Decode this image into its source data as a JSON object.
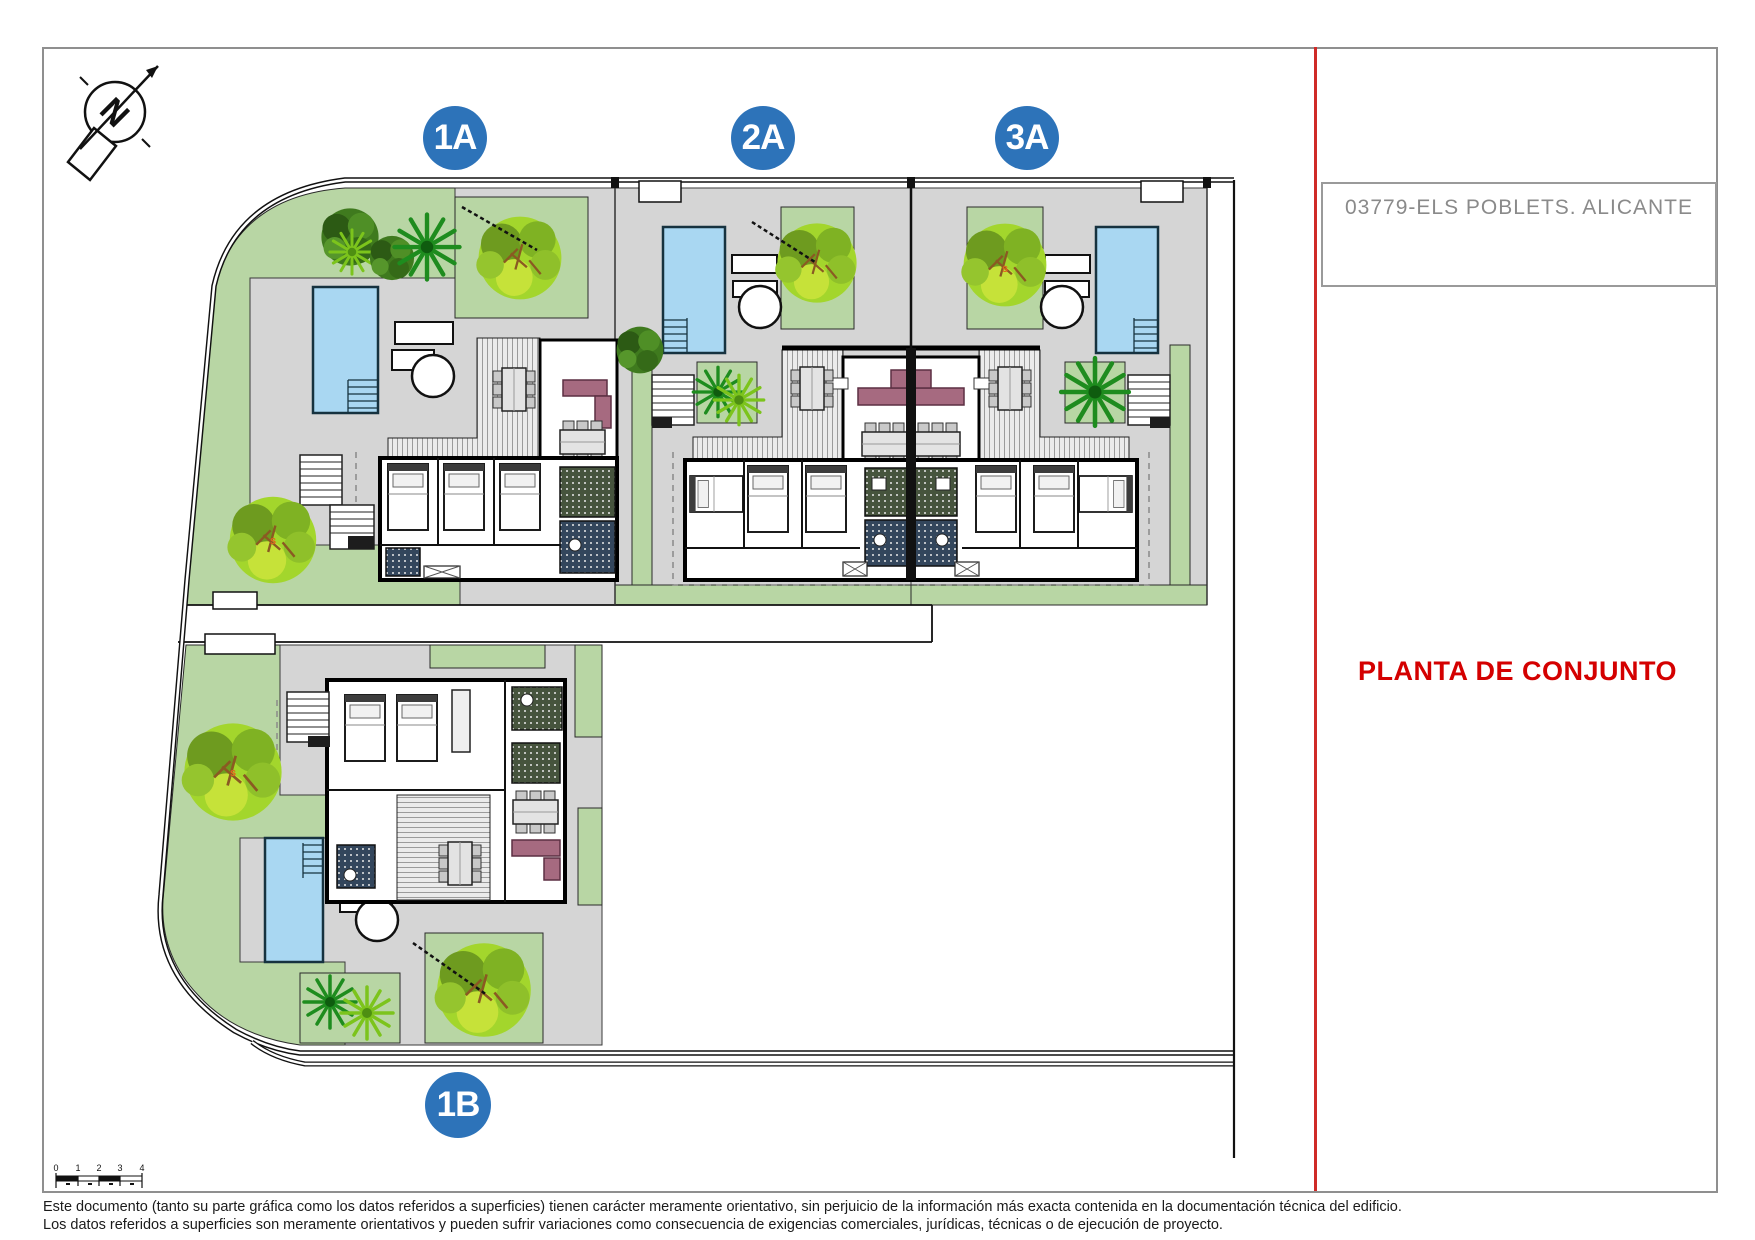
{
  "header": {
    "project_code": "03779-ELS POBLETS. ALICANTE"
  },
  "plan_label": "PLANTA DE CONJUNTO",
  "badges": {
    "unit_1a": "1A",
    "unit_2a": "2A",
    "unit_3a": "3A",
    "unit_1b": "1B"
  },
  "compass": {
    "letter": "N"
  },
  "scale_bar": {
    "labels": [
      "0",
      "1",
      "2",
      "3",
      "4"
    ]
  },
  "tree_marks": {
    "mark": "s"
  },
  "footer": {
    "line1": "Este documento (tanto su parte gráfica como los datos referidos a superficies) tienen carácter meramente orientativo, sin perjuicio de la información más exacta contenida en la documentación técnica del edificio.",
    "line2": "Los datos referidos a superficies son meramente orientativos y pueden sufrir variaciones como consecuencia de exigencias comerciales, jurídicas, técnicas o de ejecución de proyecto."
  },
  "colors": {
    "badge_blue": "#2d73b9",
    "accent_red": "#cf2a27",
    "label_red": "#d40000",
    "title_gray": "#8a8a8a",
    "lawn_green": "#b8d6a4",
    "paving_gray": "#d5d5d5",
    "pool_blue": "#a9d7f2",
    "sofa_mauve": "#a66a80"
  }
}
